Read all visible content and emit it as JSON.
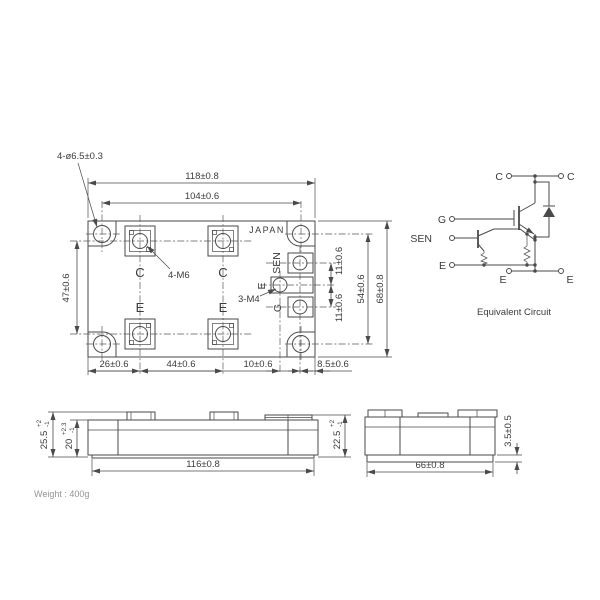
{
  "colors": {
    "line": "#4a4a4a",
    "text": "#3a3a3a",
    "background": "#ffffff"
  },
  "top_view": {
    "brand": "JAPAN",
    "hole_note": "4-ø6.5±0.3",
    "main_screw_note": "4-M6",
    "aux_screw_note": "3-M4",
    "terminals": {
      "c1": "C",
      "c2": "C",
      "e1": "E",
      "e2": "E",
      "sen": "SEN",
      "e_aux": "E",
      "g": "G"
    },
    "dims": {
      "width": "118±0.8",
      "hole_span": "104±0.6",
      "height": "68±0.8",
      "right_hole_span": "54±0.6",
      "terminal_row_span": "47±0.6",
      "aux_pitch_top": "11±0.6",
      "aux_pitch_bottom": "11±0.6",
      "bottom_a": "26±0.6",
      "bottom_b": "44±0.6",
      "bottom_c": "10±0.6",
      "bottom_d": "8.5±0.6"
    }
  },
  "front_view": {
    "dims": {
      "total_height": "25.5",
      "total_height_plus": "+2",
      "total_height_minus": "-1",
      "case_height": "20",
      "case_height_plus": "+2.3",
      "case_height_minus": "-1",
      "base_width": "116±0.8",
      "right_height": "22.5",
      "right_height_plus": "+2",
      "right_height_minus": "-1"
    }
  },
  "side_view": {
    "dims": {
      "width": "66±0.8",
      "flange_height": "3.5±0.5"
    }
  },
  "circuit": {
    "caption": "Equivalent Circuit",
    "c_top_left": "C",
    "c_top_right": "C",
    "g": "G",
    "sen": "SEN",
    "e_left": "E",
    "e_bottom_left": "E",
    "e_bottom_right": "E"
  },
  "footnote": "Weight : 400g"
}
